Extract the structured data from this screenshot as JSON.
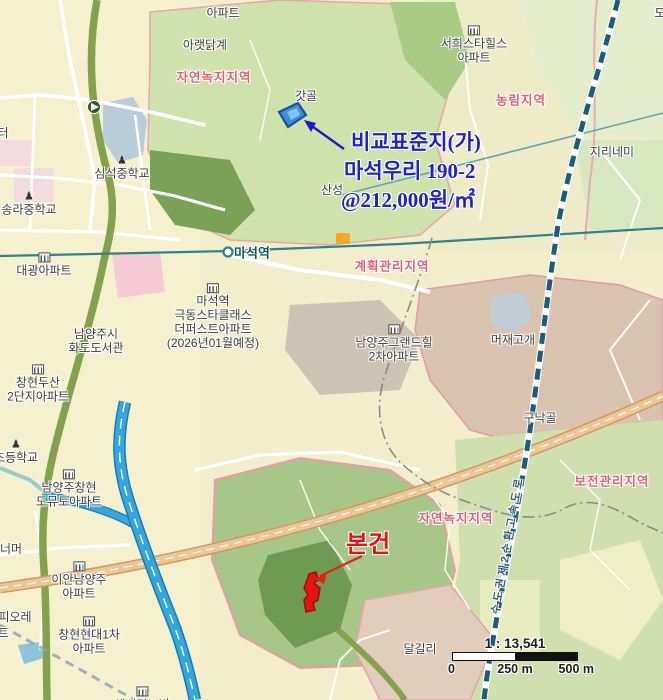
{
  "annotations": {
    "comparison": {
      "line1": "비교표준지(가)",
      "line2": "마석우리 190-2",
      "line3": "@212,000원/㎡",
      "color": "#2121cc"
    },
    "subject": {
      "label": "본건",
      "color": "#e41414"
    },
    "expressway_name": "수도권제2순환고속도로",
    "expressway_color": "#2f6076"
  },
  "scalebar": {
    "ratio": "1 : 13,541",
    "t0": "0",
    "t250": "250 m",
    "t500": "500 m"
  },
  "map": {
    "parcels": {
      "comparison": {
        "fill": "#3f8fd4",
        "stroke": "#15539e",
        "inner": "#85c4ec",
        "arrow": "#1a1ac8"
      },
      "subject": {
        "fill": "#e41414",
        "stroke": "#9e0c0c",
        "arrow": "#e02414"
      }
    },
    "station": {
      "name": "마석역",
      "line_color": "#2f8289"
    },
    "labels": [
      {
        "id": "apartment-top",
        "type": "place",
        "lines": [
          "아파트"
        ],
        "x": 223,
        "y": 13
      },
      {
        "id": "araetdakgye",
        "type": "place",
        "lines": [
          "아랫닭계"
        ],
        "x": 205,
        "y": 45
      },
      {
        "id": "zone-natural-top",
        "type": "zone",
        "lines": [
          "자연녹지지역"
        ],
        "x": 214,
        "y": 78
      },
      {
        "id": "gatgol",
        "type": "place",
        "lines": [
          "갓골"
        ],
        "x": 306,
        "y": 96
      },
      {
        "id": "seohee-star-hills",
        "type": "place",
        "icon": "building",
        "lines": [
          "서희스타힐스",
          "아파트"
        ],
        "x": 474,
        "y": 45
      },
      {
        "id": "zone-nonglim",
        "type": "zone",
        "lines": [
          "농림지역"
        ],
        "x": 521,
        "y": 101
      },
      {
        "id": "jirinemi",
        "type": "place",
        "lines": [
          "지리네미"
        ],
        "x": 612,
        "y": 152
      },
      {
        "id": "do-partial",
        "type": "place",
        "lines": [
          "도"
        ],
        "x": 660,
        "y": 13
      },
      {
        "id": "sanseong",
        "type": "place",
        "lines": [
          "산성"
        ],
        "x": 332,
        "y": 190
      },
      {
        "id": "simseok-middle-school",
        "type": "place",
        "icon": "school",
        "lines": [
          "심석중학교"
        ],
        "x": 122,
        "y": 168
      },
      {
        "id": "songra-middle-school",
        "type": "place",
        "icon": "school",
        "lines": [
          "송라중학교"
        ],
        "x": 29,
        "y": 204
      },
      {
        "id": "teo-partial",
        "type": "place",
        "lines": [
          "터"
        ],
        "x": 3,
        "y": 133
      },
      {
        "id": "maseok-station",
        "type": "station",
        "lines": [
          "마석역"
        ],
        "x": 252,
        "y": 253
      },
      {
        "id": "zone-plan-mgmt",
        "type": "zone",
        "lines": [
          "계획관리지역"
        ],
        "x": 392,
        "y": 267
      },
      {
        "id": "daegwang-apt",
        "type": "place",
        "icon": "building",
        "lines": [
          "대광아파트"
        ],
        "x": 44,
        "y": 265
      },
      {
        "id": "geukdong-starclass",
        "type": "place",
        "icon": "building",
        "lines": [
          "마석역",
          "극동스타클래스",
          "더퍼스트아파트",
          "(2026년01월예정)"
        ],
        "x": 213,
        "y": 317
      },
      {
        "id": "hwado-library",
        "type": "place",
        "lines": [
          "남양주시",
          "화도도서관"
        ],
        "x": 96,
        "y": 341
      },
      {
        "id": "changhyun-doosan-apt",
        "type": "place",
        "icon": "building",
        "lines": [
          "창현두산",
          "2단지아파트"
        ],
        "x": 38,
        "y": 384
      },
      {
        "id": "grandhill-apt",
        "type": "place",
        "icon": "building",
        "lines": [
          "남양주그랜드힐",
          "2차아파트"
        ],
        "x": 394,
        "y": 344
      },
      {
        "id": "meojae-gogae",
        "type": "place",
        "lines": [
          "머재고개"
        ],
        "x": 513,
        "y": 340
      },
      {
        "id": "gunakgol",
        "type": "place",
        "lines": [
          "구낙골"
        ],
        "x": 540,
        "y": 418
      },
      {
        "id": "elementary-school-partial",
        "type": "place",
        "icon": "school",
        "lines": [
          "초등학교"
        ],
        "x": 16,
        "y": 452
      },
      {
        "id": "domuto-apt",
        "type": "place",
        "icon": "building",
        "lines": [
          "남양주창현",
          "도뮤토아파트"
        ],
        "x": 69,
        "y": 489
      },
      {
        "id": "neomeo-partial",
        "type": "place",
        "lines": [
          "너머"
        ],
        "x": 11,
        "y": 549
      },
      {
        "id": "ian-namyangju-apt",
        "type": "place",
        "icon": "building",
        "lines": [
          "이안남양주",
          "아파트"
        ],
        "x": 79,
        "y": 581
      },
      {
        "id": "piore-partial",
        "type": "place",
        "lines": [
          "피오레"
        ],
        "x": 15,
        "y": 617
      },
      {
        "id": "teu-partial",
        "type": "place",
        "lines": [
          "트"
        ],
        "x": 3,
        "y": 633
      },
      {
        "id": "changhyun-hyundai-apt",
        "type": "place",
        "icon": "building",
        "lines": [
          "창현현대1차",
          "아파트"
        ],
        "x": 89,
        "y": 636
      },
      {
        "id": "dalgilli",
        "type": "place",
        "lines": [
          "달길리"
        ],
        "x": 420,
        "y": 649
      },
      {
        "id": "zone-bojeon",
        "type": "zone",
        "lines": [
          "보전관리지역"
        ],
        "x": 612,
        "y": 482
      },
      {
        "id": "zone-natural-bottom",
        "type": "zone",
        "lines": [
          "자연녹지지역"
        ],
        "x": 456,
        "y": 519
      },
      {
        "id": "bottom-apt-partial",
        "type": "place",
        "icon": "building",
        "lines": [
          "에시티노빌"
        ],
        "x": 142,
        "y": 699
      }
    ]
  }
}
